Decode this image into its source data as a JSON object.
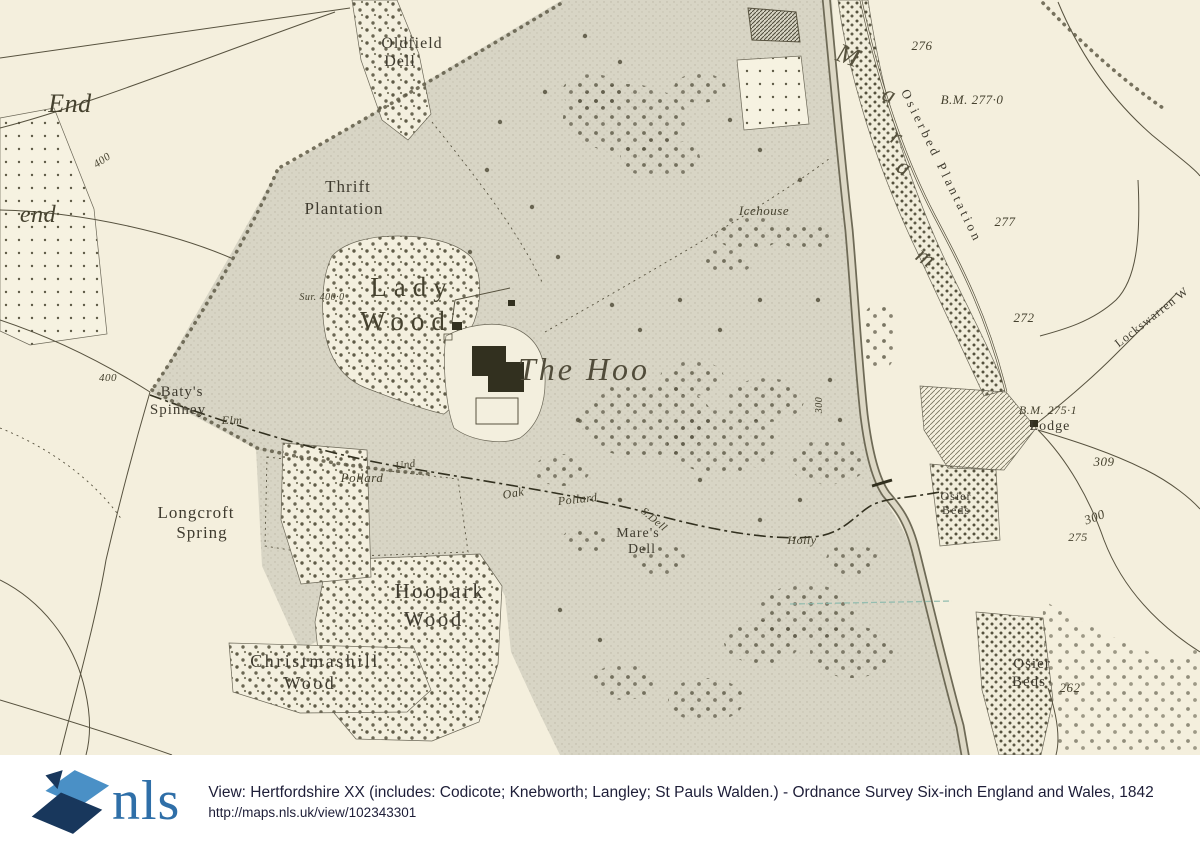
{
  "map": {
    "colors": {
      "paper": "#f4efdd",
      "park": "#d8d5c5",
      "wood_dots": "#5f5b47",
      "ink": "#57523f",
      "ink_dark": "#32301f",
      "label": "#3f3b2f",
      "water": "#6e6a56",
      "teal": "#8ab8ac"
    },
    "labels": [
      {
        "id": "end-upper",
        "t": "End",
        "x": 70,
        "y": 112,
        "s": 26,
        "c": "ital",
        "r": 0
      },
      {
        "id": "end-lower",
        "t": "end",
        "x": 38,
        "y": 222,
        "s": 24,
        "c": "ital",
        "r": 0
      },
      {
        "id": "oldfield-1",
        "t": "Oldfield",
        "x": 412,
        "y": 48,
        "s": 16,
        "c": "ant",
        "r": 0
      },
      {
        "id": "oldfield-2",
        "t": "Dell",
        "x": 400,
        "y": 66,
        "s": 16,
        "c": "ant",
        "r": 0
      },
      {
        "id": "thrift-1",
        "t": "Thrift",
        "x": 348,
        "y": 192,
        "s": 17,
        "c": "ant",
        "r": 0
      },
      {
        "id": "thrift-2",
        "t": "Plantation",
        "x": 344,
        "y": 214,
        "s": 17,
        "c": "ant",
        "r": 0
      },
      {
        "id": "sur-400",
        "t": "Sur. 400·0",
        "x": 322,
        "y": 300,
        "s": 10,
        "c": "ital",
        "r": 0
      },
      {
        "id": "lady-1",
        "t": "Lady",
        "x": 412,
        "y": 296,
        "s": 27,
        "c": "wood",
        "r": 0
      },
      {
        "id": "lady-2",
        "t": "Wood",
        "x": 406,
        "y": 330,
        "s": 27,
        "c": "wood",
        "r": 0
      },
      {
        "id": "the-hoo",
        "t": "The Hoo",
        "x": 584,
        "y": 380,
        "s": 32,
        "c": "bigital",
        "r": 0
      },
      {
        "id": "batys-1",
        "t": "Baty's",
        "x": 182,
        "y": 396,
        "s": 15,
        "c": "ant",
        "r": 0
      },
      {
        "id": "batys-2",
        "t": "Spinney",
        "x": 178,
        "y": 414,
        "s": 15,
        "c": "ant",
        "r": 0
      },
      {
        "id": "elm",
        "t": "Elm",
        "x": 232,
        "y": 424,
        "s": 12,
        "c": "ital",
        "r": 0
      },
      {
        "id": "und",
        "t": "Und",
        "x": 406,
        "y": 468,
        "s": 11,
        "c": "ital",
        "r": -8
      },
      {
        "id": "pollard-w",
        "t": "Pollard",
        "x": 362,
        "y": 482,
        "s": 13,
        "c": "ital",
        "r": 0
      },
      {
        "id": "oak",
        "t": "Oak",
        "x": 514,
        "y": 497,
        "s": 12,
        "c": "ital",
        "r": -10
      },
      {
        "id": "pollard-m",
        "t": "Pollard",
        "x": 578,
        "y": 503,
        "s": 12,
        "c": "ital",
        "r": -6
      },
      {
        "id": "s-dell",
        "t": "S.Dell",
        "x": 652,
        "y": 522,
        "s": 11,
        "c": "ital",
        "r": 40
      },
      {
        "id": "holly",
        "t": "Holly",
        "x": 802,
        "y": 544,
        "s": 12,
        "c": "ital",
        "r": 0
      },
      {
        "id": "mares-1",
        "t": "Mare's",
        "x": 638,
        "y": 537,
        "s": 14,
        "c": "ant",
        "r": 0
      },
      {
        "id": "mares-2",
        "t": "Dell",
        "x": 642,
        "y": 553,
        "s": 14,
        "c": "ant",
        "r": 0
      },
      {
        "id": "longcroft-1",
        "t": "Longcroft",
        "x": 196,
        "y": 518,
        "s": 17,
        "c": "ant",
        "r": 0
      },
      {
        "id": "longcroft-2",
        "t": "Spring",
        "x": 202,
        "y": 538,
        "s": 17,
        "c": "ant",
        "r": 0
      },
      {
        "id": "hoopark-1",
        "t": "Hoopark",
        "x": 440,
        "y": 598,
        "s": 21,
        "c": "ant2",
        "r": 0
      },
      {
        "id": "hoopark-2",
        "t": "Wood",
        "x": 434,
        "y": 626,
        "s": 21,
        "c": "ant2",
        "r": 0
      },
      {
        "id": "xmas-1",
        "t": "Christmashill",
        "x": 315,
        "y": 667,
        "s": 18,
        "c": "ant2",
        "r": 0
      },
      {
        "id": "xmas-2",
        "t": "Wood",
        "x": 310,
        "y": 689,
        "s": 18,
        "c": "ant2",
        "r": 0
      },
      {
        "id": "icehouse",
        "t": "Icehouse",
        "x": 764,
        "y": 215,
        "s": 13,
        "c": "ital",
        "r": 0
      },
      {
        "id": "river-m",
        "t": "M",
        "x": 846,
        "y": 64,
        "s": 27,
        "c": "river",
        "r": 20
      },
      {
        "id": "river-a1",
        "t": "a",
        "x": 887,
        "y": 102,
        "s": 24,
        "c": "river",
        "r": 24
      },
      {
        "id": "river-r",
        "t": "r",
        "x": 894,
        "y": 144,
        "s": 24,
        "c": "river",
        "r": 28
      },
      {
        "id": "river-a2",
        "t": "a",
        "x": 901,
        "y": 174,
        "s": 24,
        "c": "river",
        "r": 30
      },
      {
        "id": "river-m2",
        "t": "m",
        "x": 922,
        "y": 264,
        "s": 24,
        "c": "river",
        "r": 35
      },
      {
        "id": "osierbed-plantation",
        "t": "Osierbed Plantation",
        "x": 938,
        "y": 168,
        "s": 13,
        "c": "antsp",
        "r": 64
      },
      {
        "id": "num-276",
        "t": "276",
        "x": 922,
        "y": 50,
        "s": 13,
        "c": "ital",
        "r": 0
      },
      {
        "id": "bm-2770",
        "t": "B.M. 277·0",
        "x": 972,
        "y": 104,
        "s": 13,
        "c": "ital",
        "r": 0
      },
      {
        "id": "num-277",
        "t": "277",
        "x": 1005,
        "y": 226,
        "s": 13,
        "c": "ital",
        "r": 0
      },
      {
        "id": "num-272",
        "t": "272",
        "x": 1024,
        "y": 322,
        "s": 13,
        "c": "ital",
        "r": 0
      },
      {
        "id": "warren-wood",
        "t": "Lockswarren W",
        "x": 1154,
        "y": 320,
        "s": 12,
        "c": "ant",
        "r": -38
      },
      {
        "id": "bm-2751",
        "t": "B.M. 275·1",
        "x": 1048,
        "y": 414,
        "s": 12,
        "c": "ital",
        "r": 0
      },
      {
        "id": "lodge",
        "t": "Lodge",
        "x": 1050,
        "y": 430,
        "s": 14,
        "c": "ant",
        "r": 0
      },
      {
        "id": "num-309",
        "t": "309",
        "x": 1104,
        "y": 466,
        "s": 13,
        "c": "ital",
        "r": 0
      },
      {
        "id": "num-300",
        "t": "300",
        "x": 1096,
        "y": 521,
        "s": 13,
        "c": "ital",
        "r": -20
      },
      {
        "id": "num-275",
        "t": "275",
        "x": 1078,
        "y": 541,
        "s": 12,
        "c": "ital",
        "r": 0
      },
      {
        "id": "num-262",
        "t": "262",
        "x": 1070,
        "y": 692,
        "s": 13,
        "c": "ital",
        "r": 0
      },
      {
        "id": "osier-mid-1",
        "t": "Osier",
        "x": 956,
        "y": 500,
        "s": 12,
        "c": "ant",
        "r": 0
      },
      {
        "id": "osier-mid-2",
        "t": "Beds",
        "x": 956,
        "y": 514,
        "s": 12,
        "c": "ant",
        "r": 0
      },
      {
        "id": "osier-bot-1",
        "t": "Osier",
        "x": 1032,
        "y": 668,
        "s": 15,
        "c": "ant",
        "r": 0
      },
      {
        "id": "osier-bot-2",
        "t": "Beds",
        "x": 1029,
        "y": 686,
        "s": 15,
        "c": "ant",
        "r": 0
      },
      {
        "id": "num-400-road",
        "t": "400",
        "x": 104,
        "y": 163,
        "s": 11,
        "c": "ital",
        "r": -35
      },
      {
        "id": "num-400-w",
        "t": "400",
        "x": 108,
        "y": 381,
        "s": 11,
        "c": "ital",
        "r": 0
      },
      {
        "id": "num-300-river",
        "t": "300",
        "x": 822,
        "y": 405,
        "s": 10,
        "c": "ital",
        "r": -90
      }
    ]
  },
  "footer": {
    "logo_text": "nls",
    "logo_colors": {
      "light": "#4a90c6",
      "dark": "#18375c",
      "text": "#2f6fa8"
    },
    "view_line": "View: Hertfordshire XX (includes: Codicote; Knebworth; Langley; St Pauls Walden.) - Ordnance Survey Six-inch England and Wales, 1842",
    "url_line": "http://maps.nls.uk/view/102343301"
  }
}
